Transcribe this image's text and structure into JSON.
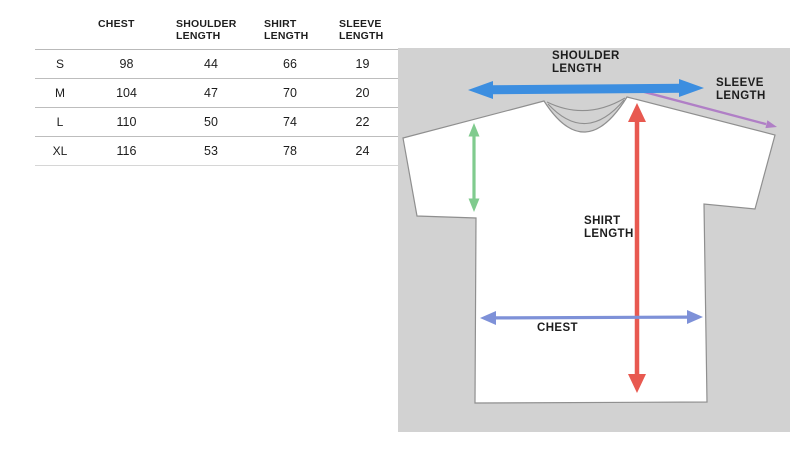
{
  "size_chart": {
    "columns": [
      "",
      "CHEST",
      "SHOULDER\nLENGTH",
      "SHIRT\nLENGTH",
      "SLEEVE\nLENGTH"
    ],
    "rows": [
      {
        "size": "S",
        "chest": "98",
        "shoulder_length": "44",
        "shirt_length": "66",
        "sleeve_length": "19"
      },
      {
        "size": "M",
        "chest": "104",
        "shoulder_length": "47",
        "shirt_length": "70",
        "sleeve_length": "20"
      },
      {
        "size": "L",
        "chest": "110",
        "shoulder_length": "50",
        "shirt_length": "74",
        "sleeve_length": "22"
      },
      {
        "size": "XL",
        "chest": "116",
        "shoulder_length": "53",
        "shirt_length": "78",
        "sleeve_length": "24"
      }
    ]
  },
  "diagram": {
    "labels": {
      "shoulder_length": "SHOULDER\nLENGTH",
      "sleeve_length": "SLEEVE\nLENGTH",
      "shirt_length": "SHIRT\nLENGTH",
      "chest": "CHEST"
    },
    "colors": {
      "background": "#d2d2d2",
      "shirt_fill": "#ffffff",
      "shirt_outline": "#8f8f8f",
      "shoulder_arrow": "#3c8ee0",
      "sleeve_arrow": "#b07fc6",
      "armhole_arrow": "#80cb8e",
      "shirt_length_arrow": "#e85950",
      "chest_arrow": "#7e91d8"
    }
  }
}
